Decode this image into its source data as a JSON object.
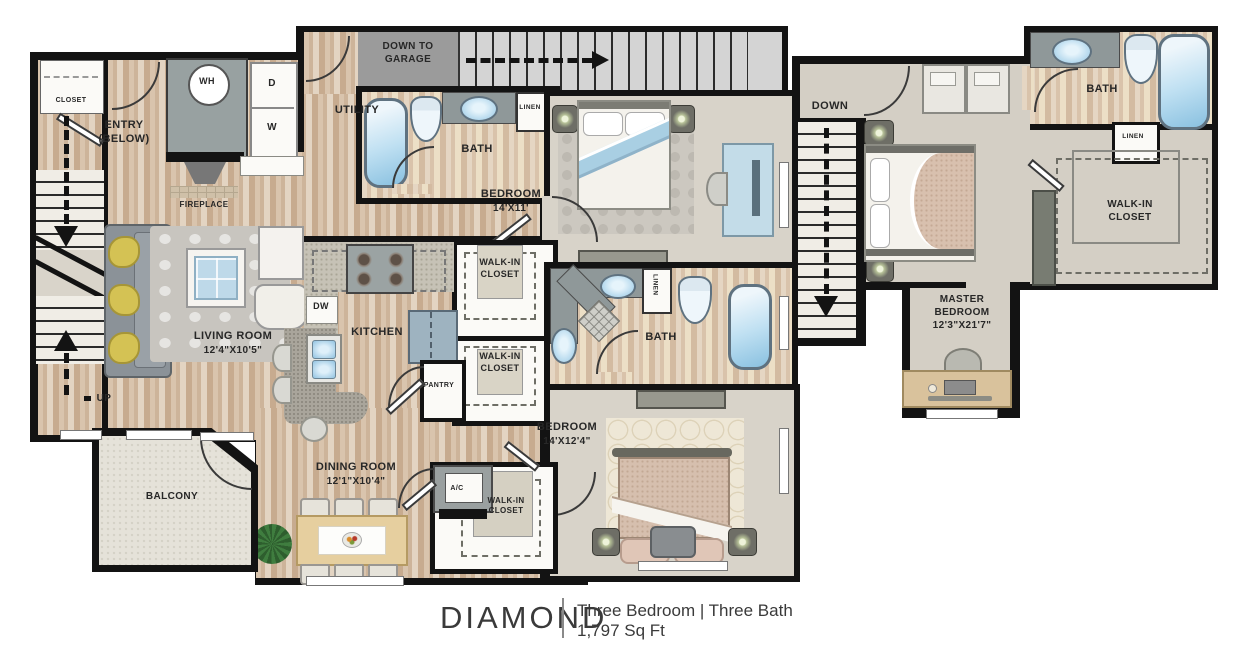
{
  "plan": {
    "name": "DIAMOND",
    "configuration": "Three Bedroom | Three Bath",
    "area": "1,797 Sq Ft"
  },
  "floor1": {
    "closet": "CLOSET",
    "entry": [
      "ENTRY",
      "(BELOW)"
    ],
    "up": "UP",
    "garage_stairs": [
      "DOWN TO",
      "GARAGE"
    ],
    "utility": "UTILITY",
    "water_heater": "WH",
    "dryer": "D",
    "washer": "W",
    "fireplace": "FIREPLACE",
    "bath": "BATH",
    "linen": "LINEN",
    "bedroom1": {
      "name": "BEDROOM",
      "dims": "14'X11'"
    },
    "walk_in_closet": [
      "WALK-IN",
      "CLOSET"
    ],
    "kitchen": "KITCHEN",
    "dishwasher": "DW",
    "pantry": "PANTRY",
    "living_room": {
      "name": "LIVING ROOM",
      "dims": "12'4\"X10'5\""
    },
    "dining_room": {
      "name": "DINING ROOM",
      "dims": "12'1\"X10'4\""
    },
    "balcony": "BALCONY",
    "bedroom2": {
      "name": "BEDROOM",
      "dims": "14'X12'4\""
    },
    "ac": "A/C"
  },
  "floor2": {
    "down": "DOWN",
    "bath": "BATH",
    "linen": "LINEN",
    "walk_in_closet": [
      "WALK-IN",
      "CLOSET"
    ],
    "master_bedroom": {
      "name": [
        "MASTER",
        "BEDROOM"
      ],
      "dims": "12'3\"X21'7\""
    }
  }
}
